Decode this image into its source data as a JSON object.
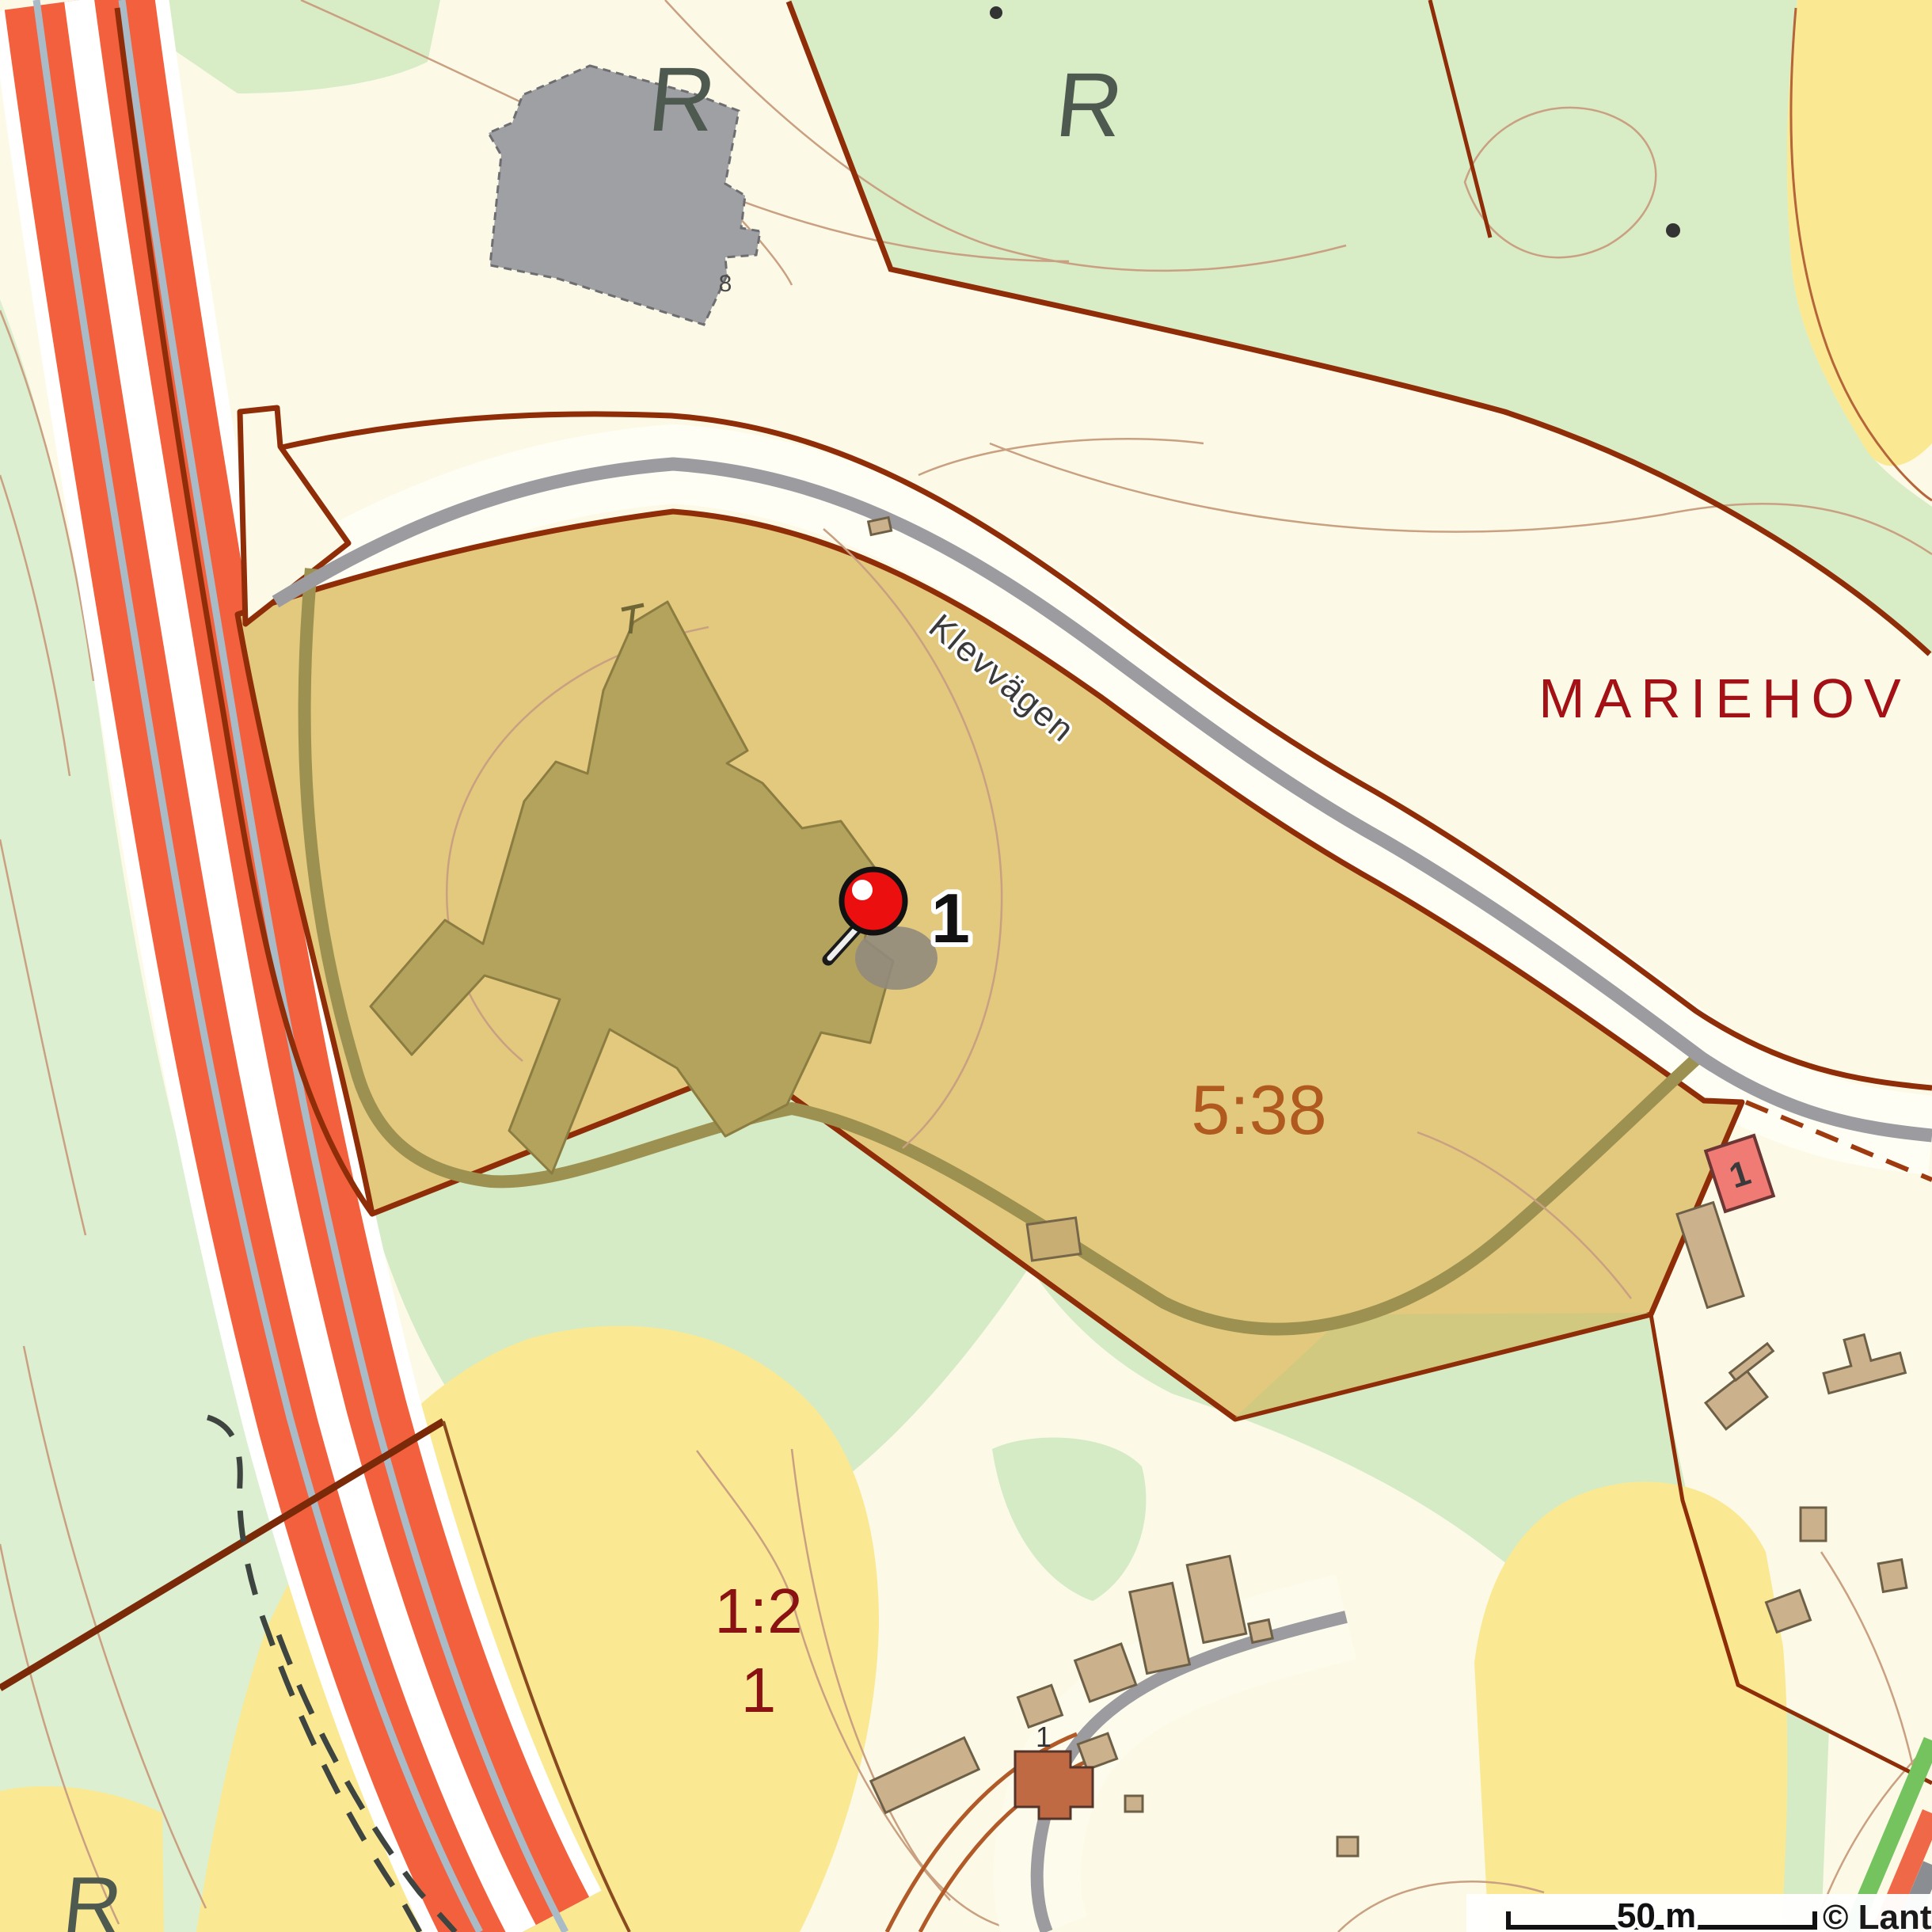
{
  "map": {
    "place_label": "MARIEHOV",
    "parcel_label": "5:38",
    "parcel2_label_line1": "1:2",
    "parcel2_label_line2": "1",
    "road_label": "Klevvägen",
    "rune_label": "R",
    "gray_building_label": "8",
    "red_building_label": "1",
    "brown_building_label": "1",
    "marker": {
      "label": "1"
    },
    "scalebar": {
      "distance_label": "50 m"
    },
    "attribution": "© Lantmäterie",
    "colors": {
      "background_cream": "#fcfae6",
      "forest_green": "#d8ecc6",
      "field_yellow": "#fae992",
      "parcel_highlight_tan": "#e3c97e",
      "building_footprint_olive": "#b3a35c",
      "boundary_dark_red": "#8f2d08",
      "highway_orange": "#f2603d",
      "highway_centerline_blue": "#aabbc8",
      "road_gray": "#9c9ca0",
      "contour_brown": "#c9a081",
      "building_tan": "#cbb18c",
      "building_red": "#ef7b74",
      "building_brown": "#bf6a42",
      "gray_building": "#9fa0a4",
      "label_dark_red": "#a31016",
      "parcel_label_orange": "#b05a20",
      "marker_red": "#ec0f0f",
      "rune_gray": "#4e5a50"
    }
  }
}
